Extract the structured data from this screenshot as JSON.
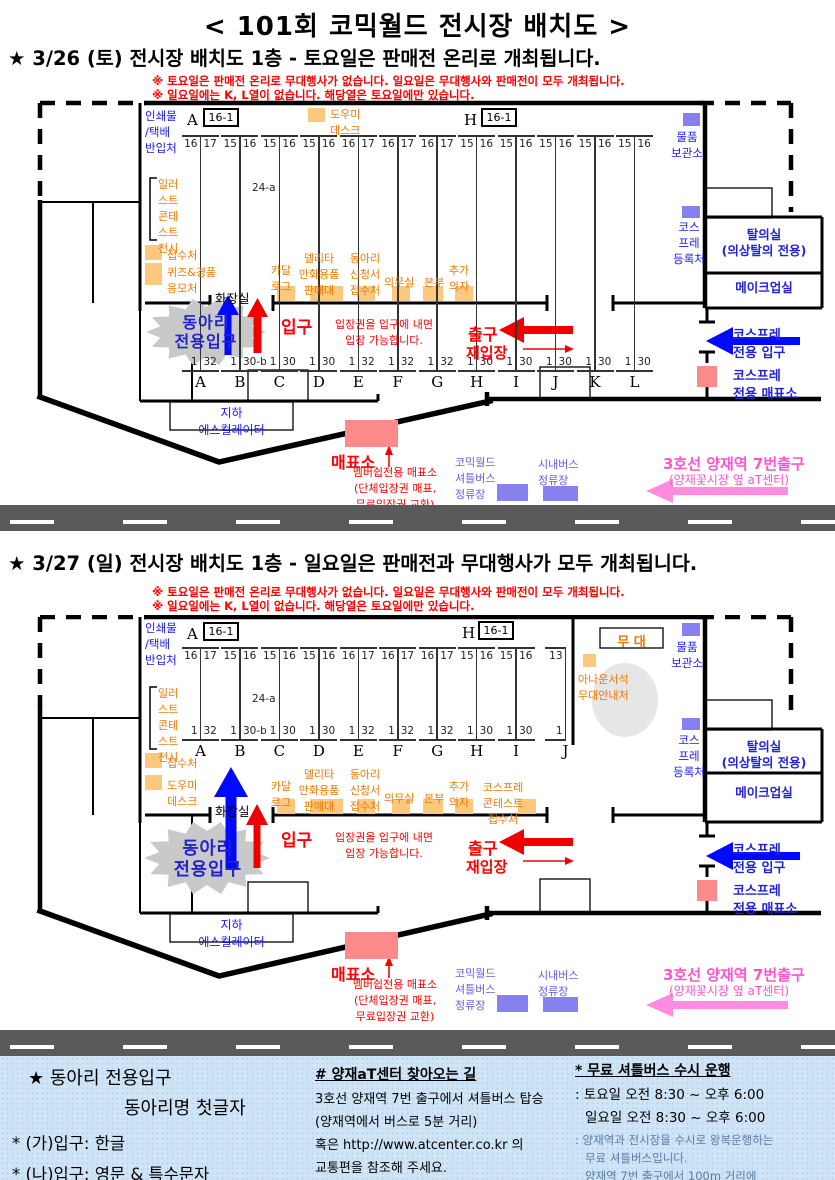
{
  "title": "< 101회 코믹월드 전시장 배치도 >",
  "saturday": {
    "heading": "★ 3/26 (토) 전시장 배치도 1층 - 토요일은 판매전 온리로 개최됩니다.",
    "notes": [
      "※ 토요일은 판매전 온리로 무대행사가 없습니다. 일요일은 무대행사와 판매전이 모두 개최됩니다.",
      "※ 일요일에는 K, L열이 없습니다. 해당열은 토요일에만 있습니다."
    ],
    "booths": [
      {
        "letter": "A",
        "tl": "16",
        "tr": "17",
        "bl": "1",
        "br": "32"
      },
      {
        "letter": "B",
        "tl": "15",
        "tr": "16",
        "bl": "1",
        "br": "30-b",
        "mid": "24-a"
      },
      {
        "letter": "C",
        "tl": "15",
        "tr": "16",
        "bl": "1",
        "br": "30"
      },
      {
        "letter": "D",
        "tl": "15",
        "tr": "16",
        "bl": "1",
        "br": "30"
      },
      {
        "letter": "E",
        "tl": "16",
        "tr": "17",
        "bl": "1",
        "br": "32"
      },
      {
        "letter": "F",
        "tl": "16",
        "tr": "17",
        "bl": "1",
        "br": "32"
      },
      {
        "letter": "G",
        "tl": "16",
        "tr": "17",
        "bl": "1",
        "br": "32"
      },
      {
        "letter": "H",
        "tl": "15",
        "tr": "16",
        "bl": "1",
        "br": "30"
      },
      {
        "letter": "I",
        "tl": "15",
        "tr": "16",
        "bl": "1",
        "br": "30"
      },
      {
        "letter": "J",
        "tl": "15",
        "tr": "16",
        "bl": "1",
        "br": "30"
      },
      {
        "letter": "K",
        "tl": "15",
        "tr": "16",
        "bl": "1",
        "br": "30"
      },
      {
        "letter": "L",
        "tl": "15",
        "tr": "16",
        "bl": "1",
        "br": "30"
      }
    ]
  },
  "sunday": {
    "heading": "★ 3/27 (일) 전시장 배치도 1층 - 일요일은 판매전과 무대행사가 모두 개최됩니다.",
    "notes": [
      "※ 토요일은 판매전 온리로 무대행사가 없습니다. 일요일은 무대행사와 판매전이 모두 개최됩니다.",
      "※ 일요일에는 K, L열이 없습니다. 해당열은 토요일에만 있습니다."
    ],
    "booths": [
      {
        "letter": "A",
        "tl": "16",
        "tr": "17",
        "bl": "1",
        "br": "32"
      },
      {
        "letter": "B",
        "tl": "15",
        "tr": "16",
        "bl": "1",
        "br": "30-b",
        "mid": "24-a"
      },
      {
        "letter": "C",
        "tl": "15",
        "tr": "16",
        "bl": "1",
        "br": "30"
      },
      {
        "letter": "D",
        "tl": "15",
        "tr": "16",
        "bl": "1",
        "br": "30"
      },
      {
        "letter": "E",
        "tl": "16",
        "tr": "17",
        "bl": "1",
        "br": "32"
      },
      {
        "letter": "F",
        "tl": "16",
        "tr": "17",
        "bl": "1",
        "br": "32"
      },
      {
        "letter": "G",
        "tl": "16",
        "tr": "17",
        "bl": "1",
        "br": "32"
      },
      {
        "letter": "H",
        "tl": "15",
        "tr": "16",
        "bl": "1",
        "br": "30"
      },
      {
        "letter": "I",
        "tl": "15",
        "tr": "16",
        "bl": "1",
        "br": "30"
      },
      {
        "letter": "J",
        "tl": "13",
        "bl": "1",
        "half": true
      }
    ]
  },
  "corner_letters": {
    "a": "A",
    "h": "H"
  },
  "corner_box": "16-1",
  "labels": {
    "printing": "인쇄물\n/택배\n반입처",
    "illust_contest": "일러\n스트\n콘테\n스트\n전시",
    "reception": "접수처",
    "quiz_draw": "퀴즈&경품\n응모처",
    "helper_desk": "도우미\n데스크",
    "toilet": "화장실",
    "storage": "물품\n보관소",
    "cosplay_reg": "코스\n프레\n등록처",
    "dressing_room": "탈의실\n(의상탈의 전용)",
    "makeup_room": "메이크업실",
    "catalog": "카달\n로그",
    "delita_goods": "델리타\n만화용품\n판매대",
    "club_form_desk": "동아리\n신청서\n접수처",
    "medical": "의무실",
    "hq": "본부",
    "extra_chairs": "추가\n의자",
    "cosplay_contest_desk": "코스프레\n콘테스트\n접수처",
    "club_entrance": "동아리\n전용입구",
    "entrance": "입구",
    "entrance_note": "입장권을 입구에 내면\n입장 가능합니다.",
    "exit": "출구",
    "reentry": "재입장",
    "cosplay_entrance": "코스프레\n전용 입구",
    "cosplay_ticket_office": "코스프레\n전용 매표소",
    "underground_escalator": "지하\n에스컬레이터",
    "ticket_office": "매표소",
    "ticket_office_note": "멤버쉽전용 매표소\n(단체입장권 매표,\n무료입장권 교환)",
    "shuttle_stop": "코믹월드\n셔틀버스\n정류장",
    "city_bus_stop": "시내버스\n정류장",
    "subway_exit": "3호선 양재역 7번출구",
    "subway_exit_sub": "(양재꽃시장 옆 aT센터)",
    "stage": "무 대",
    "announcer_desk": "아나운서석\n무대안내처"
  },
  "footer": {
    "club": {
      "line1": "★ 동아리 전용입구",
      "line2": "동아리명 첫글자",
      "line3": "* (가)입구: 한글",
      "line4": "* (나)입구: 영문 & 특수문자"
    },
    "directions": {
      "title": "# 양재aT센터 찾아오는 길",
      "lines": [
        "3호선 양재역 7번 출구에서 셔틀버스 탑승",
        "(양재역에서 버스로 5분 거리)",
        "혹은 http://www.atcenter.co.kr 의",
        "교통편을 참조해 주세요."
      ],
      "note": "#2층전시장은 타행사가 개최됩니다."
    },
    "shuttle": {
      "title": "* 무료 셔틀버스 수시 운행",
      "hours": [
        ": 토요일 오전 8:30 ~ 오후 6:00",
        "일요일 오전 8:30 ~ 오후 6:00"
      ],
      "desc": [
        ": 양재역과 전시장을 수시로 왕복운행하는",
        "무료 셔틀버스입니다.",
        "양재역 7번 출구에서 100m 거리에",
        "셔틀버스 탑승처가 있습니다."
      ]
    }
  },
  "colors": {
    "orange_marker": "#fbc87e",
    "violet_marker": "#8781f0",
    "pink_marker": "#fb8b8b",
    "orange_text": "#f07800",
    "blue_text": "#1a1aff",
    "red_text": "#ff0000",
    "magenta_text": "#ff55cc",
    "road_gray": "#5a5a5a",
    "footer_bg": "#cfe4f6"
  }
}
